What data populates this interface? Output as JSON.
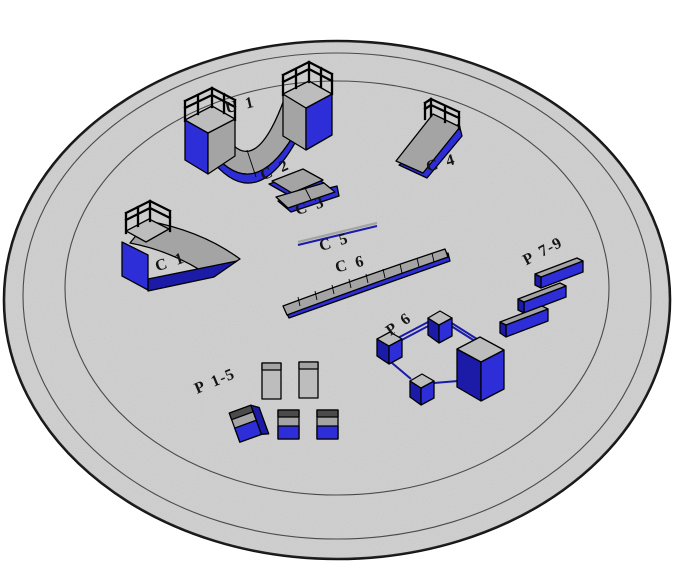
{
  "colors": {
    "background": "#ffffff",
    "ground": "#d3d3d3",
    "ground_edge": "#141414",
    "ring": "#4a4a4a",
    "blue": "#2e2ed8",
    "blue_dark": "#1b1ba8",
    "gray": "#a4a4a4",
    "gray_light": "#bdbdbd",
    "gray_dark": "#4b4b4b",
    "outline": "#000000",
    "label": "#141414"
  },
  "obstacles": {
    "u1": {
      "label": "U 1",
      "kind": "halfpipe"
    },
    "c1": {
      "label": "C 1",
      "kind": "quarterpipe-with-railing"
    },
    "c2": {
      "label": "C 2",
      "kind": "bank-ramp"
    },
    "c3": {
      "label": "C 3",
      "kind": "bank-ramp"
    },
    "c4": {
      "label": "C 4",
      "kind": "bank-ramp-with-railing"
    },
    "c5": {
      "label": "C 5",
      "kind": "flat-rail"
    },
    "c6": {
      "label": "C 6",
      "kind": "curved-segmented-ledge"
    },
    "p15": {
      "label": "P 1-5",
      "kind": "panels-and-boxes"
    },
    "p6": {
      "label": "P 6",
      "kind": "boxes-with-connecting-rails"
    },
    "p79": {
      "label": "P 7-9",
      "kind": "three-parallel-ledges"
    }
  }
}
